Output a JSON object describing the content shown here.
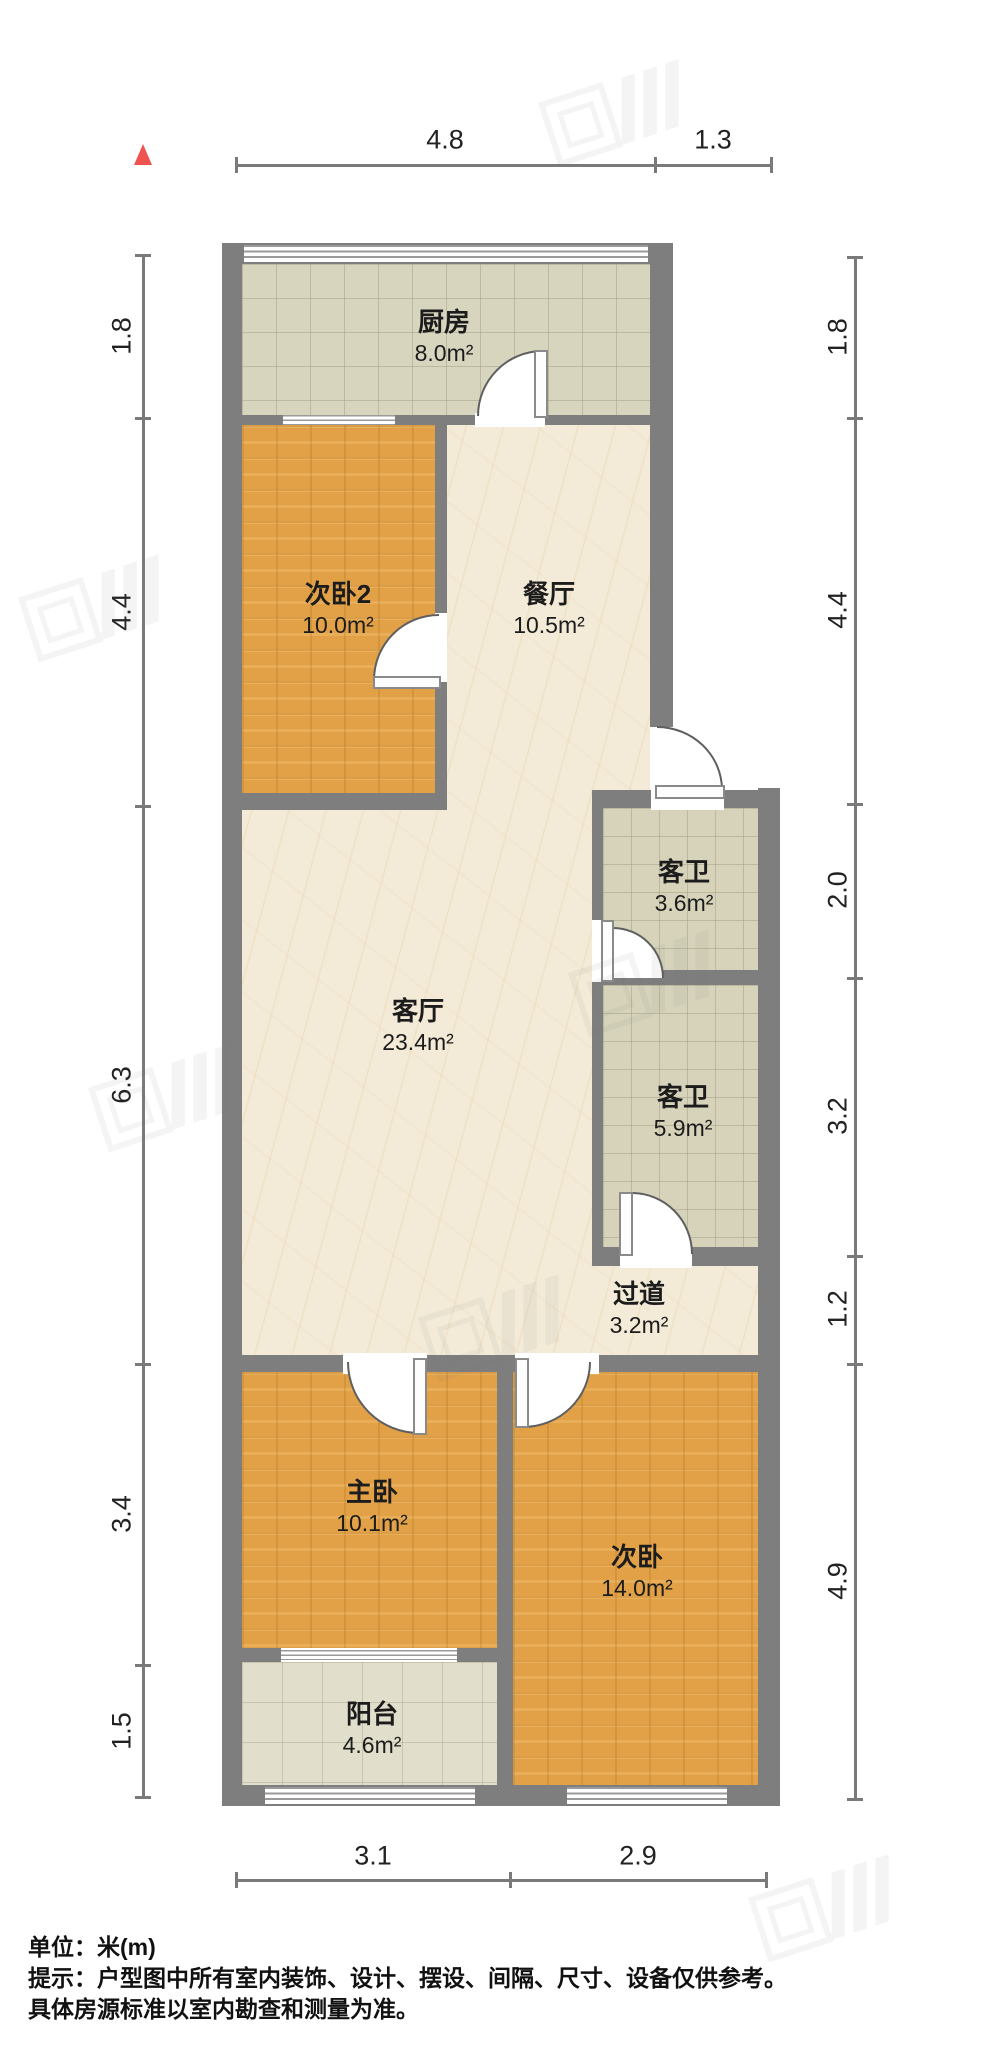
{
  "title": "户型图",
  "unit_scale": "米(m)",
  "rooms": [
    {
      "name": "厨房",
      "area": "8.0m²"
    },
    {
      "name": "次卧2",
      "area": "10.0m²"
    },
    {
      "name": "餐厅",
      "area": "10.5m²"
    },
    {
      "name": "客卫",
      "area": "3.6m²"
    },
    {
      "name": "客厅",
      "area": "23.4m²"
    },
    {
      "name": "客卫",
      "area": "5.9m²"
    },
    {
      "name": "过道",
      "area": "3.2m²"
    },
    {
      "name": "主卧",
      "area": "10.1m²"
    },
    {
      "name": "次卧",
      "area": "14.0m²"
    },
    {
      "name": "阳台",
      "area": "4.6m²"
    }
  ],
  "dimensions": {
    "top": [
      "4.8",
      "1.3"
    ],
    "bottom": [
      "3.1",
      "2.9"
    ],
    "left": [
      "1.8",
      "4.4",
      "6.3",
      "3.4",
      "1.5"
    ],
    "right": [
      "1.8",
      "4.4",
      "2.0",
      "3.2",
      "1.2",
      "4.9"
    ]
  },
  "footer": {
    "line1": "单位：米(m)",
    "line2": "提示：户型图中所有室内装饰、设计、摆设、间隔、尺寸、设备仅供参考。",
    "line3": "具体房源标准以室内勘查和测量为准。"
  },
  "colors": {
    "wall": "#7e7e7e",
    "wood_floor": "#e2a146",
    "marble_floor": "#f3ebd8",
    "kitchen_tile": "#d8d5bf",
    "bath_tile": "#d6d3ba",
    "balcony_tile": "#e1decb",
    "north_arrow": "#ef5350",
    "dim_text": "#222222"
  }
}
